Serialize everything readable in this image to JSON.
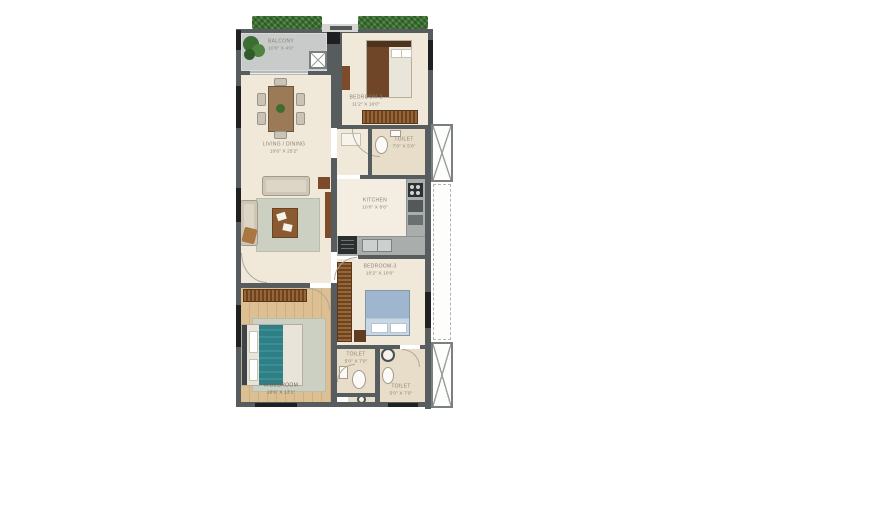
{
  "plan_title": "apartment-floor-plan",
  "rooms": {
    "balcony": {
      "label": "BALCONY",
      "dims": "10'0\" X 4'0\""
    },
    "bedroom2": {
      "label": "BEDROOM-2",
      "dims": "11'2\" X 10'0\""
    },
    "living_dining": {
      "label": "LIVING / DINING",
      "dims": "10'6\" X 25'2\""
    },
    "toilet_top": {
      "label": "TOILET",
      "dims": "7'0\" X 5'0\""
    },
    "kitchen": {
      "label": "KITCHEN",
      "dims": "10'0\" X 8'6\""
    },
    "bedroom3": {
      "label": "BEDROOM-3",
      "dims": "10'2\" X 10'0\""
    },
    "master_bedroom": {
      "label": "M.BEDROOM",
      "dims": "10'6\" X 13'1\""
    },
    "toilet_left": {
      "label": "TOILET",
      "dims": "5'0\" X 7'0\""
    },
    "toilet_right": {
      "label": "TOILET",
      "dims": "5'0\" X 7'0\""
    }
  },
  "colors": {
    "wall": "#575c5e",
    "window_marker": "#1f2022",
    "floor_beige": "#f0e8d9",
    "balcony_floor": "#c8cbca",
    "toilet_floor": "#e7ddc9",
    "wood_floor": "#d8b888",
    "hedge_green": "#3f7238",
    "counter_gray": "#a9aeac",
    "wardrobe_brown": "#8a5a33",
    "teal_bedding": "#2e7f86",
    "blue_bedding": "#a9c0d7",
    "rug_gray": "#ccd0c2",
    "furniture_brown": "#7b4b2a",
    "label_text": "#8b8378"
  }
}
